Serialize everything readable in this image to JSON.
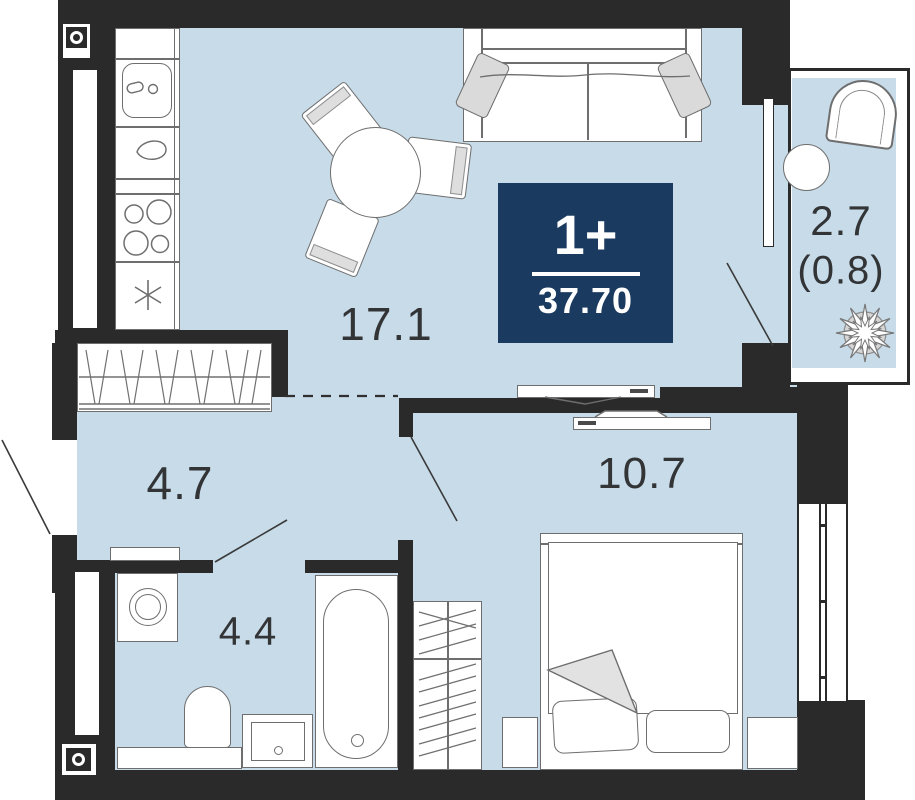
{
  "badge": {
    "rooms_type": "1+",
    "total_area": "37.70"
  },
  "rooms": {
    "living_kitchen": {
      "label": "17.1"
    },
    "hallway": {
      "label": "4.7"
    },
    "bathroom": {
      "label": "4.4"
    },
    "bedroom": {
      "label": "10.7"
    },
    "balcony": {
      "label": "2.7",
      "coefficient_label": "(0.8)"
    }
  },
  "colors": {
    "wall": "#2a2a2a",
    "floor_fill": "#c7dbe9",
    "badge_background": "#1b3a5f",
    "badge_text": "#ffffff",
    "furniture_line": "#6e6e6e",
    "label_text": "#323436"
  },
  "icons": {
    "shaft_marker": "circle-in-square",
    "fridge_marker": "asterisk-star",
    "plant": "flower-star"
  }
}
